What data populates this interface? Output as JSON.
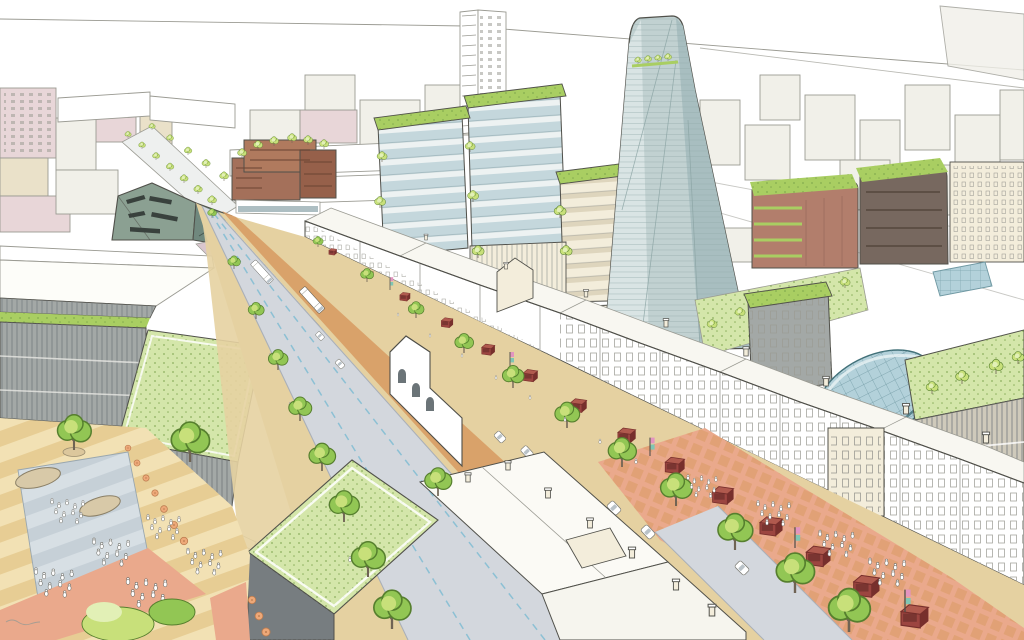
{
  "image": {
    "kind": "hand-drawn architectural masterplan aerial illustration",
    "subject": "Aerial sketch visualisation of a regenerated town-centre high street with market stalls, street trees, cycle lanes, green-roofed buildings, a tapering glass tower and a public square with playground",
    "visible_text": "",
    "signature": "illegible pencil scribble, bottom-left corner"
  },
  "palette": {
    "paper": "#ffffff",
    "inkLine": "#50504a",
    "inkLight": "#9b9b93",
    "blockFill": "#f1f0e9",
    "blockPink": "#e8d6d8",
    "blockBeige": "#eae1c9",
    "roadGrey": "#d3d7dd",
    "roadEdge": "#aab0b8",
    "laneBlue": "#8cc0d4",
    "sidewalkTan": "#e5d1a1",
    "brickOrange": "#d79a60",
    "crossingSalmon": "#eaa98c",
    "plazaTan": "#e7cd94",
    "plazaTanLight": "#f2e1b4",
    "playBlue": "#c6d0d7",
    "playBlueLight": "#d7dfe4",
    "treeLight": "#c8e07a",
    "treeMid": "#92c654",
    "treeDark": "#567f2e",
    "trunkBrown": "#6f6354",
    "greenRoof": "#a9ce62",
    "greenRoofLight": "#d4e6aa",
    "greenSpeckle": "#79a14a",
    "glassBlue": "#c4d7dc",
    "glassPale": "#edf2f2",
    "glassEdge": "#8fa9ae",
    "towerGlass": "#c1d1d1",
    "towerGlassDark": "#a8bec0",
    "towerGlassLight": "#dae5e5",
    "stallRed": "#9c4540",
    "stallRedDark": "#772f2c",
    "stallRoof": "#b05a4e",
    "parasolOrange": "#eda878",
    "facadeGrey": "#a3a8a6",
    "facadeGreyDark": "#777d80",
    "brickRed": "#b27e6c",
    "brickRedDark": "#92655a",
    "domeBlue": "#b3d1da",
    "domeLine": "#6f98a2",
    "domeEdge": "#417078",
    "cream": "#f3eddb",
    "creamDark": "#ded5bd",
    "windowDark": "#39413d",
    "angularGreen": "#8ba092",
    "angularGreenDark": "#70887e",
    "mauvePlaza": "#d9c6ce",
    "bannerPink": "#e394c0",
    "bannerTeal": "#7fc6b4",
    "busWindow": "#b9c2c8"
  },
  "scene": {
    "elements": [
      {
        "name": "sky",
        "note": "blank paper sky with slanted distant horizon lines"
      },
      {
        "name": "background-cityscape",
        "note": "pale outlined blocks, pink and beige tints, left and top-right"
      },
      {
        "name": "residential-tower-block",
        "note": "white high-rise with window grid, top centre"
      },
      {
        "name": "glass-tower",
        "note": "tapering faceted glass skyscraper with rooftop sky-garden trees"
      },
      {
        "name": "midrise-glass-cluster",
        "note": "three stacked-floor glass buildings with bright green roofs and terrace trees"
      },
      {
        "name": "timber-terrace-building",
        "note": "brown stepped building with roof trees, upper left"
      },
      {
        "name": "angular-landmark-building",
        "note": "grey-green faceted building with slash windows"
      },
      {
        "name": "brick-buildings-right",
        "note": "red-brick rounded slabs with green terraces and roofs"
      },
      {
        "name": "victorian-terraces",
        "note": "long white shopfront terraces lining the east side of the high street"
      },
      {
        "name": "high-street",
        "note": "grey roadway with dashed blue cycle lanes, tan footways, brick paving strip"
      },
      {
        "name": "market-stalls",
        "note": "row of dark-red open-fronted market stalls along the street"
      },
      {
        "name": "street-trees",
        "note": "avenues of green trees on both sides of the street"
      },
      {
        "name": "banner-poles",
        "note": "poles with small pink and teal flags between stalls"
      },
      {
        "name": "vehicles",
        "note": "white double-decker bus, smaller buses, cars, van"
      },
      {
        "name": "pedestrian-crossing-plaza",
        "note": "salmon brick-grid paved junction with many tiny pedestrians"
      },
      {
        "name": "public-square",
        "note": "striped tan plaza with blue playground, play sculptures, café parasols, crowds"
      },
      {
        "name": "green-roof-buildings-left",
        "note": "grey striated buildings with large speckled green roofs"
      },
      {
        "name": "green-roof-box-building",
        "note": "dark-walled hall with big speckled green roof, bottom centre"
      },
      {
        "name": "rooftop-cluster",
        "note": "white terrace rooftops with chimneys, bottom centre"
      },
      {
        "name": "church-building",
        "note": "white building with arched windows on west side"
      },
      {
        "name": "glass-vault-roof",
        "note": "blue gridded barrel-vault arcade roof, right"
      },
      {
        "name": "modern-balcony-building",
        "note": "right-edge building with balcony facade and rooftop garden"
      },
      {
        "name": "artist-signature-scribble",
        "note": "illegible"
      }
    ]
  }
}
